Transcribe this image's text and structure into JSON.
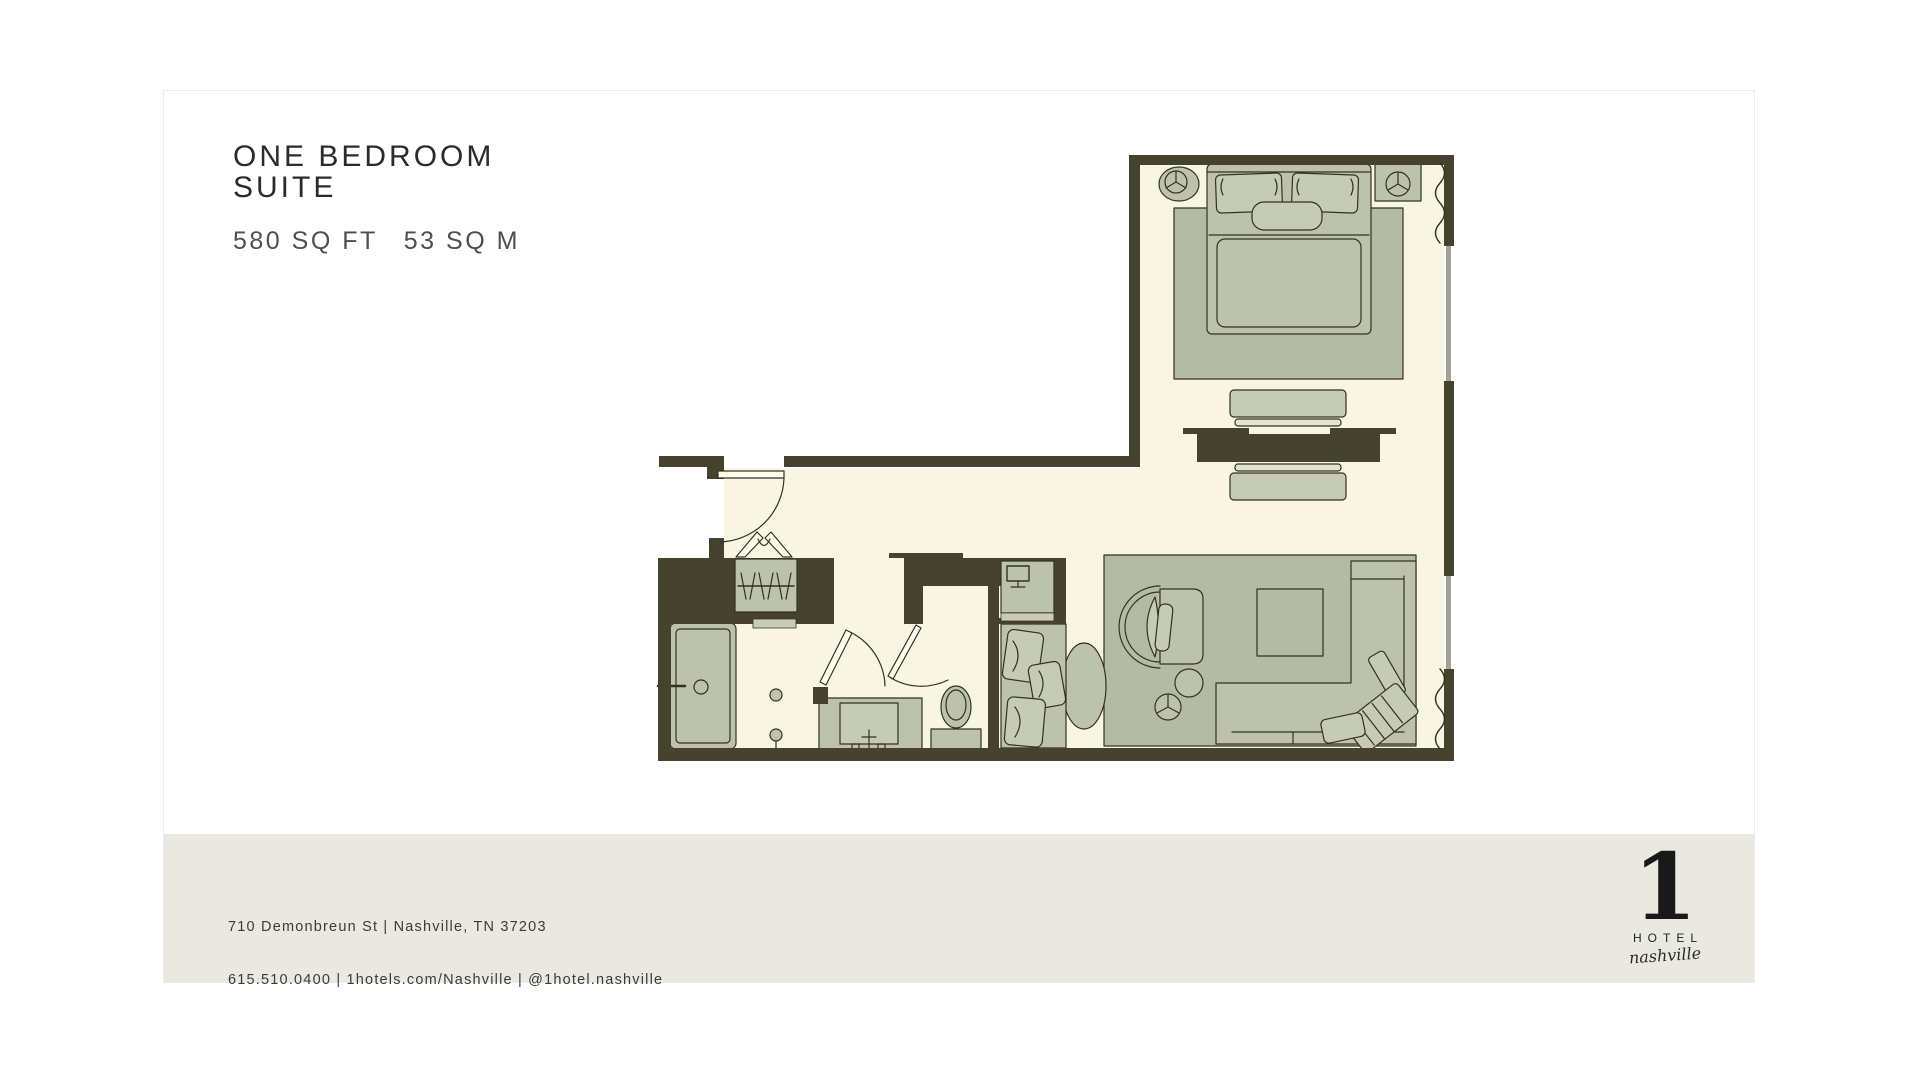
{
  "header": {
    "title_line1": "ONE BEDROOM",
    "title_line2": "SUITE",
    "area_imperial": "580 SQ FT",
    "area_metric": "53 SQ M"
  },
  "floorplan": {
    "colors": {
      "walls": "#454330",
      "floor": "#f8f5e3",
      "furniture": "#bcc2ac",
      "furniture_light": "#c6cbb5",
      "rug": "#b4bba4",
      "outline": "#33321f",
      "window": "#a2a295",
      "footer_band": "#e9e9e1"
    }
  },
  "footer": {
    "address": "710 Demonbreun St | Nashville, TN 37203",
    "contact": "615.510.0400 | 1hotels.com/Nashville | @1hotel.nashville"
  },
  "logo": {
    "numeral": "1",
    "word": "HOTEL",
    "location": "nashville"
  }
}
